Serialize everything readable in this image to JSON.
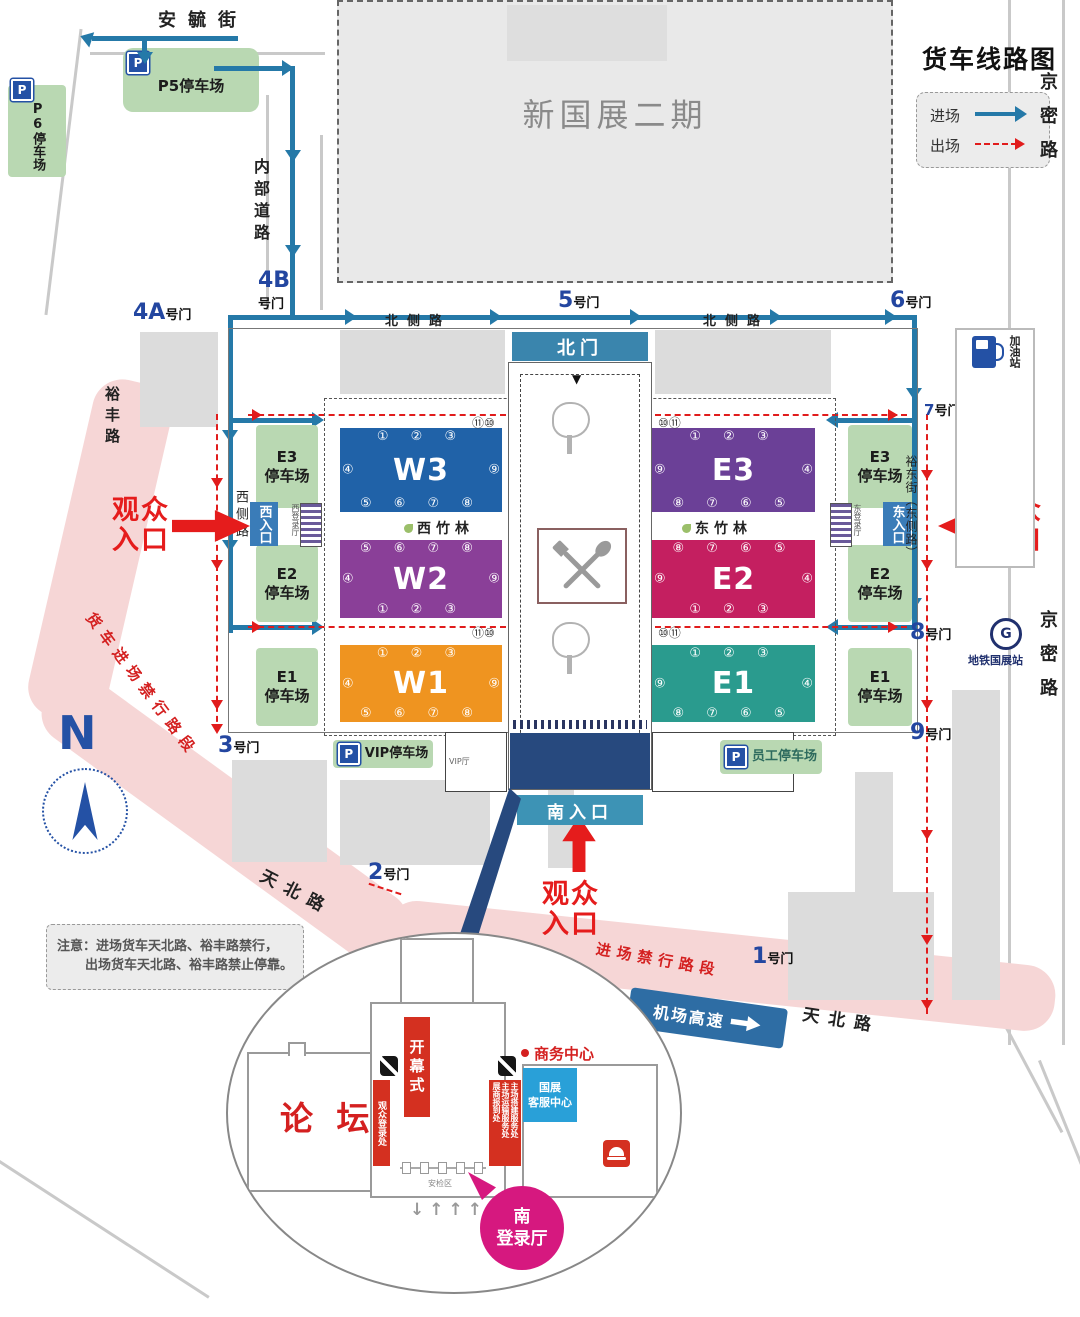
{
  "legend": {
    "title": "货车线路图",
    "entry": "进场",
    "exit": "出场"
  },
  "streets": {
    "anyu": "安毓街",
    "neibu": "内部道路",
    "beice_w": "北侧路",
    "beice_e": "北侧路",
    "jingmi_top": "京密路",
    "jingmi_mid": "京密路",
    "yufeng": "裕丰路",
    "xice": "西侧路",
    "yudong": "裕东街（东侧路）",
    "tianbei_w": "天北路",
    "tianbei_e": "天北路",
    "airport": "机场高速",
    "truck_ban": "货车进场禁行路段",
    "entry_ban": "进场禁行路段"
  },
  "gates": {
    "g1": {
      "n": "1",
      "s": "号门"
    },
    "g2": {
      "n": "2",
      "s": "号门"
    },
    "g3": {
      "n": "3",
      "s": "号门"
    },
    "g4a": {
      "n": "4A",
      "s": "号门"
    },
    "g4b": {
      "n": "4B",
      "s": "号门"
    },
    "g5": {
      "n": "5",
      "s": "号门"
    },
    "g6": {
      "n": "6",
      "s": "号门"
    },
    "g7": {
      "n": "7",
      "s": "号门"
    },
    "g8": {
      "n": "8",
      "s": "号门"
    },
    "g9": {
      "n": "9",
      "s": "号门"
    }
  },
  "site": {
    "phase2": "新国展二期",
    "north_gate": "北门",
    "south_entrance": "南入口",
    "west_entrance": "西入口",
    "east_entrance": "东入口",
    "west_bamboo": "西竹林",
    "east_bamboo": "东竹林",
    "west_hall": "西登录厅",
    "east_hall": "东登录厅",
    "vip_hall": "VIP厅",
    "security": "安检区",
    "down_mark": "▼",
    "up_mark": "▲"
  },
  "halls": {
    "w3": {
      "id": "W3",
      "top": "① ② ③",
      "bottom": "⑤ ⑥ ⑦ ⑧",
      "left": "④",
      "right": "⑨"
    },
    "w2": {
      "id": "W2",
      "top": "⑤ ⑥ ⑦ ⑧",
      "bottom": "① ② ③",
      "left": "④",
      "right": "⑨"
    },
    "w1": {
      "id": "W1",
      "top": "① ② ③",
      "bottom": "⑤ ⑥ ⑦ ⑧",
      "left": "④",
      "right": "⑨"
    },
    "e3": {
      "id": "E3",
      "top": "① ② ③",
      "bottom": "⑧ ⑦ ⑥ ⑤",
      "left": "⑨",
      "right": "④"
    },
    "e2": {
      "id": "E2",
      "top": "⑧ ⑦ ⑥ ⑤",
      "bottom": "① ② ③",
      "left": "⑨",
      "right": "④"
    },
    "e1": {
      "id": "E1",
      "top": "① ② ③",
      "bottom": "⑧ ⑦ ⑥ ⑤",
      "left": "⑨",
      "right": "④"
    },
    "corner_w_top": "⑪⑩",
    "corner_w_mid": "⑪⑩",
    "corner_e_top": "⑩⑪",
    "corner_e_mid": "⑩⑪"
  },
  "parking": {
    "p5": "P5停车场",
    "p6": "P6停车场",
    "vip": "VIP停车场",
    "staff": "员工停车场",
    "p_icon": "P",
    "west": [
      {
        "l1": "E3",
        "l2": "停车场"
      },
      {
        "l1": "E2",
        "l2": "停车场"
      },
      {
        "l1": "E1",
        "l2": "停车场"
      }
    ],
    "east": [
      {
        "l1": "E3",
        "l2": "停车场"
      },
      {
        "l1": "E2",
        "l2": "停车场"
      },
      {
        "l1": "E1",
        "l2": "停车场"
      }
    ]
  },
  "visitor": {
    "l1": "观众",
    "l2": "入口"
  },
  "poi": {
    "gas": "加油站",
    "metro": "地铁国展站",
    "metro_g": "G",
    "compass": "N"
  },
  "note": {
    "l1": "注意：进场货车天北路、裕丰路禁行，",
    "l2": "出场货车天北路、裕丰路禁止停靠。"
  },
  "inset": {
    "forum": "论 坛",
    "opening": "开幕式",
    "visitor_reg": "观众登录处",
    "services": [
      "主场搭建服务处",
      "主场运输服务处",
      "展商报到处"
    ],
    "business": "商务中心",
    "cs_l1": "国展",
    "cs_l2": "客服中心",
    "south_l1": "南",
    "south_l2": "登录厅",
    "arrows": "↓↑↑↑↑"
  }
}
